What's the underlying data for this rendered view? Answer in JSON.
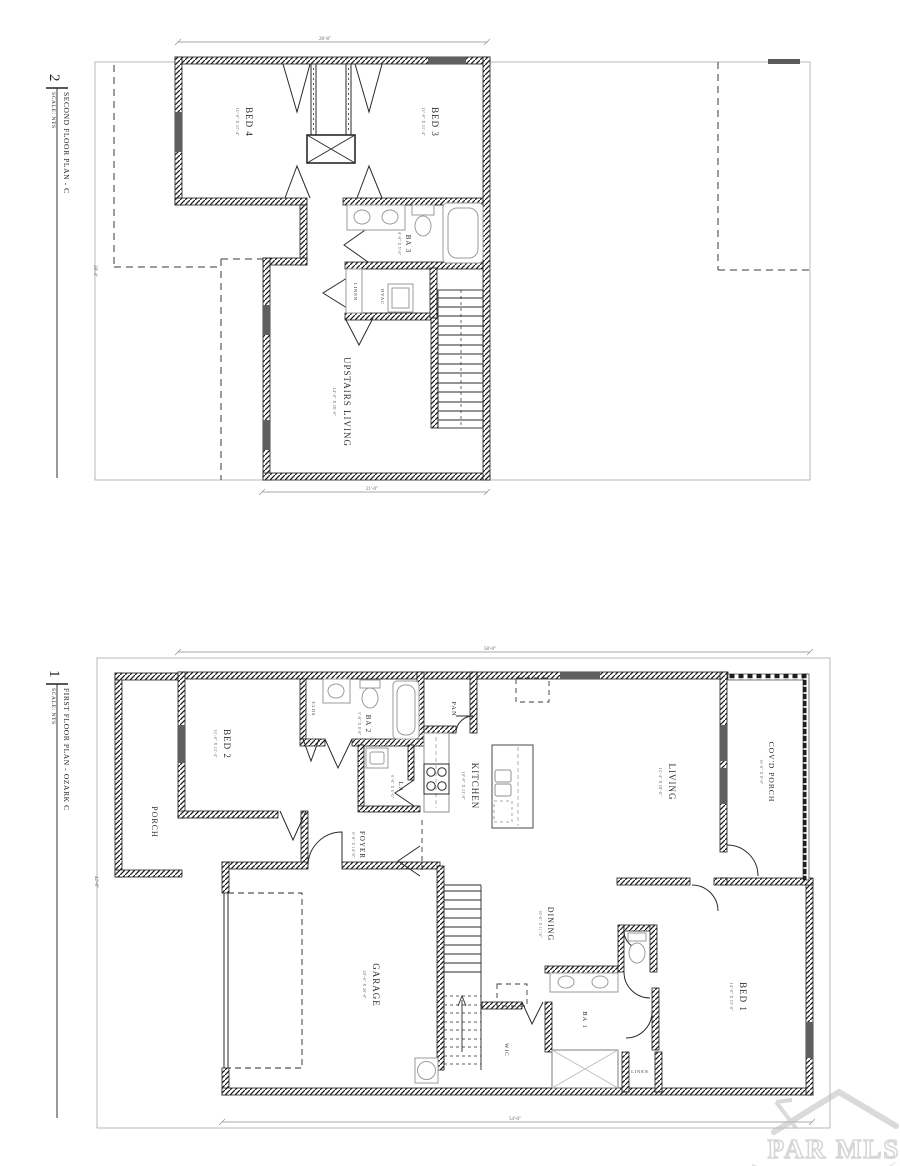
{
  "watermark": {
    "brand": "PAR MLS"
  },
  "plan2": {
    "number": "2",
    "title": "SECOND FLOOR PLAN - C",
    "scale": "SCALE: NTS",
    "dims": {
      "top": "28'-8\"",
      "bottom": "21'-0\"",
      "left": "38'-4\""
    },
    "rooms": {
      "bed4": {
        "name": "BED 4",
        "size": "11'-0\" X 11'-4\""
      },
      "bed3": {
        "name": "BED 3",
        "size": "11'-0\" X 11'-4\""
      },
      "ba3": {
        "name": "BA 3",
        "size": "8'-0\" X 5'-0\""
      },
      "linen": {
        "name": "LINEN"
      },
      "hvac": {
        "name": "HVAC"
      },
      "upstairs_living": {
        "name": "UPSTAIRS LIVING",
        "size": "14'-0\" X 16'-0\""
      }
    }
  },
  "plan1": {
    "number": "1",
    "title": "FIRST FLOOR PLAN - OZARK C",
    "scale": "SCALE: NTS",
    "dims": {
      "top": "58'-0\"",
      "bottom": "54'-0\"",
      "left": "42'-8\""
    },
    "rooms": {
      "porch": {
        "name": "PORCH"
      },
      "bed2": {
        "name": "BED 2",
        "size": "11'-0\" X 11'-4\""
      },
      "clos": {
        "name": "CLOS"
      },
      "ba2": {
        "name": "BA 2",
        "size": "5'-0\" X 8'-0\""
      },
      "la": {
        "name": "LA",
        "size": "6'-0\" X 6'-0\""
      },
      "pan": {
        "name": "PAN"
      },
      "kitchen": {
        "name": "KITCHEN",
        "size": "10'-0\" X 11'-0\""
      },
      "foyer": {
        "name": "FOYER",
        "size": "6'-0\" X 14'-0\""
      },
      "living": {
        "name": "LIVING",
        "size": "15'-4\" X 18'-0\""
      },
      "covd_porch": {
        "name": "COV'D PORCH",
        "size": "16'-0\" X 8'-0\""
      },
      "garage": {
        "name": "GARAGE",
        "size": "20'-0\" X 20'-0\""
      },
      "dining": {
        "name": "DINING",
        "size": "10'-0\" X 11'-0\""
      },
      "bed1": {
        "name": "BED 1",
        "size": "14'-0\" X 13'-0\""
      },
      "ba1": {
        "name": "BA 1"
      },
      "wic": {
        "name": "WIC"
      },
      "linen": {
        "name": "LINEN"
      }
    }
  }
}
